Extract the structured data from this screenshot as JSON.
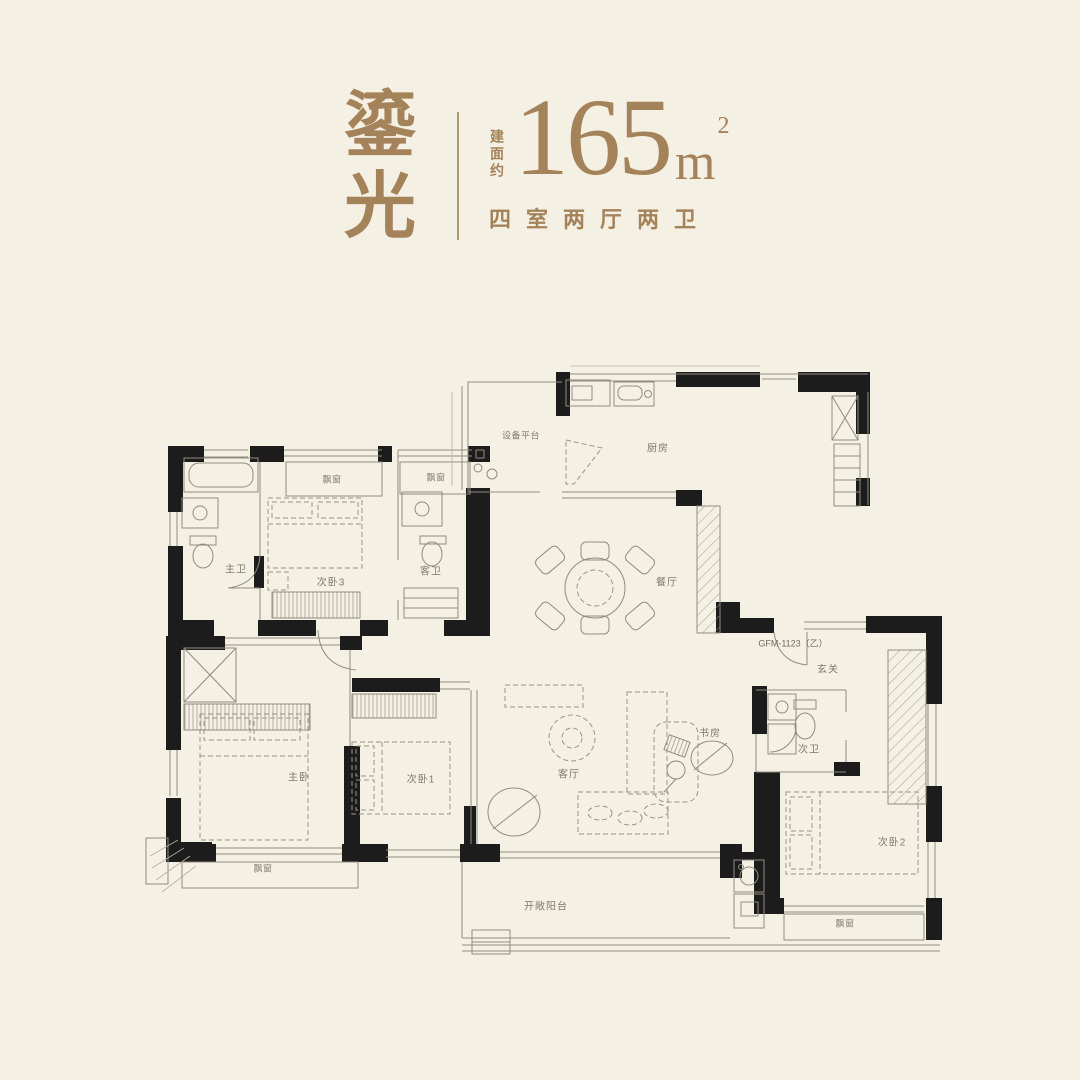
{
  "colors": {
    "background": "#f5f0e4",
    "accent": "#a5835a",
    "wall": "#1c1c1c",
    "line": "#8f8b7e"
  },
  "header": {
    "plan_name": "鎏光",
    "area_prefix": "建面约",
    "area_value": "165",
    "area_unit": "m",
    "area_exponent": "2",
    "layout_desc": "四室两厅两卫"
  },
  "floorplan": {
    "door_code": "GFM-1123（乙）",
    "rooms": {
      "equipment_platform": "设备平台",
      "kitchen": "厨房",
      "dining": "餐厅",
      "master_bath": "主卫",
      "bedroom3": "次卧3",
      "guest_bath": "客卫",
      "master_bedroom": "主卧",
      "bedroom1": "次卧1",
      "living": "客厅",
      "study": "书房",
      "foyer": "玄关",
      "second_bath": "次卫",
      "bedroom2": "次卧2",
      "balcony": "开敞阳台",
      "bay_window": "飘窗"
    }
  }
}
